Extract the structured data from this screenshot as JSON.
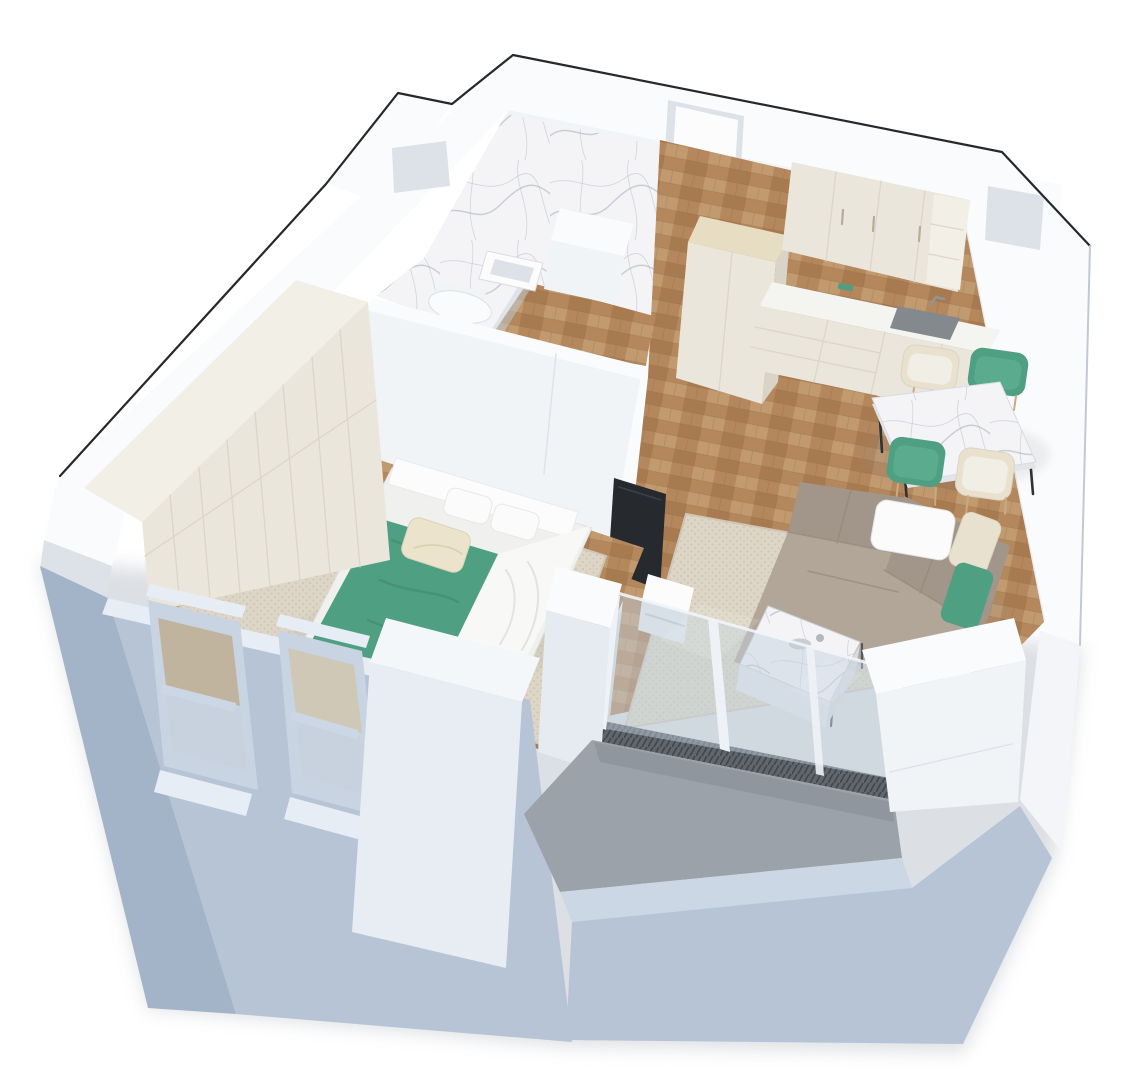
{
  "meta": {
    "description": "3D isometric cutaway rendering of a one-bedroom apartment floor plan, no text labels",
    "canvas_width": 1140,
    "canvas_height": 1087
  },
  "colors": {
    "bg": "#ffffff",
    "outline": "#26282b",
    "wallTop": "#fafbfc",
    "wallFace": "#e9edf1",
    "wallFaceLight": "#f1f4f7",
    "wallShade": "#dde2e8",
    "wallDark": "#d2d8df",
    "blue": "#b6c4d6",
    "blueShade": "#a3b3c8",
    "blueLight": "#ccd7e5",
    "blueTop": "#e7edf4",
    "wood": "#b4875d",
    "wood2": "#a87a50",
    "wood3": "#c29a6f",
    "woodLine": "#8a6a48",
    "marble": "#f4f4f6",
    "marbleVein": "#a7adbd",
    "rug": "#ddd6c6",
    "rugDot": "#cdc5b2",
    "rugShade": "#c9c1ae",
    "sofa": "#a2968a",
    "sofaLight": "#b2a698",
    "sofaDark": "#8e8375",
    "teal": "#4f9f82",
    "tealDark": "#3d8268",
    "cream": "#e9e1cd",
    "cabinet": "#eae6db",
    "cabinetTop": "#f2efe7",
    "cabinetShade": "#d9d4c6",
    "beigeTop": "#e7ddc2",
    "counter": "#f4f4f1",
    "sinkCol": "#84898e",
    "tv": "#26292d",
    "glass": "#c2d2de",
    "glassEdge": "#f0f5fa",
    "balcony": "#9ba2aa",
    "balconyDark": "#878e96",
    "legDark": "#2f3134",
    "white": "#fcfcfd",
    "shadow": "#aab0ba"
  },
  "scene": {
    "type": "architectural-3d-floorplan",
    "rooms": [
      {
        "name": "bathroom",
        "floor": "marble and wood"
      },
      {
        "name": "entry-hall",
        "floor": "wood parquet"
      },
      {
        "name": "kitchen",
        "floor": "wood parquet"
      },
      {
        "name": "dining-area",
        "floor": "wood parquet"
      },
      {
        "name": "living-room",
        "floor": "wood parquet with rug"
      },
      {
        "name": "bedroom",
        "floor": "wood parquet with rug"
      },
      {
        "name": "balcony",
        "floor": "concrete"
      }
    ],
    "furniture": {
      "bathroom": [
        "marble feature wall",
        "shower column",
        "wall-hung sink",
        "toilet"
      ],
      "kitchen": [
        "tall cabinet column",
        "upper cabinets",
        "open shelf",
        "countertop with sink",
        "drawer cabinets"
      ],
      "dining": [
        "marble dining table",
        "teal chair",
        "teal chair",
        "cream chair",
        "cream chair"
      ],
      "living": [
        "corner sofa",
        "white pillows",
        "cream pillow",
        "teal pillow",
        "marble coffee table",
        "tv",
        "media unit"
      ],
      "bedroom": [
        "double bed",
        "green throw blanket",
        "white duvet",
        "cream accent pillow",
        "wardrobe wall",
        "area rug"
      ],
      "exterior": [
        "two sash windows",
        "glass balcony wall",
        "balcony parapet",
        "service shafts"
      ]
    }
  }
}
